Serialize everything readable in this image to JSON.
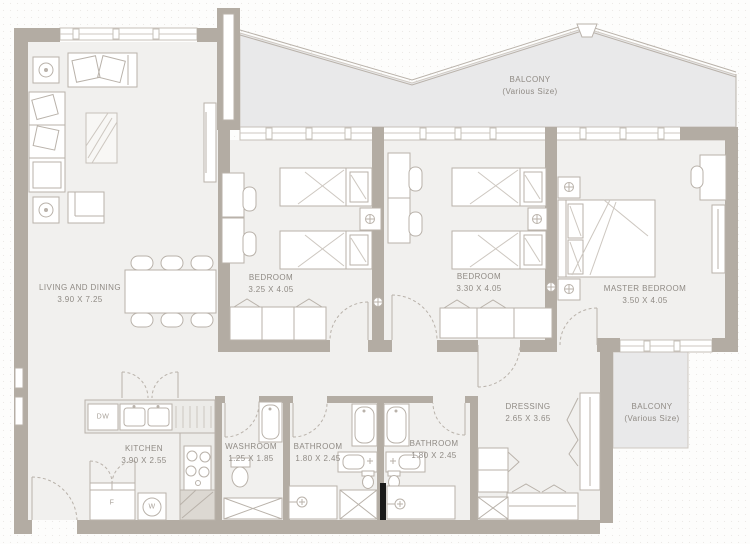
{
  "plan": {
    "type": "apartment-floor-plan",
    "rooms": [
      {
        "name": "LIVING AND DINING",
        "dims": "3.90 X 7.25"
      },
      {
        "name": "BALCONY",
        "dims": "(Various Size)"
      },
      {
        "name": "BEDROOM",
        "dims": "3.25 X 4.05"
      },
      {
        "name": "BEDROOM",
        "dims": "3.30 X 4.05"
      },
      {
        "name": "MASTER BEDROOM",
        "dims": "3.50 X 4.05"
      },
      {
        "name": "KITCHEN",
        "dims": "3.90 X 2.55"
      },
      {
        "name": "WASHROOM",
        "dims": "1.25 X 1.85"
      },
      {
        "name": "BATHROOM",
        "dims": "1.80 X 2.45"
      },
      {
        "name": "BATHROOM",
        "dims": "1.80 X 2.45"
      },
      {
        "name": "DRESSING",
        "dims": "2.65 X 3.65"
      },
      {
        "name": "BALCONY",
        "dims": "(Various Size)"
      }
    ],
    "fixtures": {
      "dishwasher": "DW",
      "fridge": "F",
      "washer": "W"
    },
    "colors": {
      "wall": "#b3aca3",
      "floor": "#f1f0ee",
      "balcony_fill": "#e9e9ea",
      "line": "#b9b2aa",
      "label_text": "#8f8a84",
      "counter": "#ecebe8",
      "shaft": "#1a1a1a"
    }
  }
}
